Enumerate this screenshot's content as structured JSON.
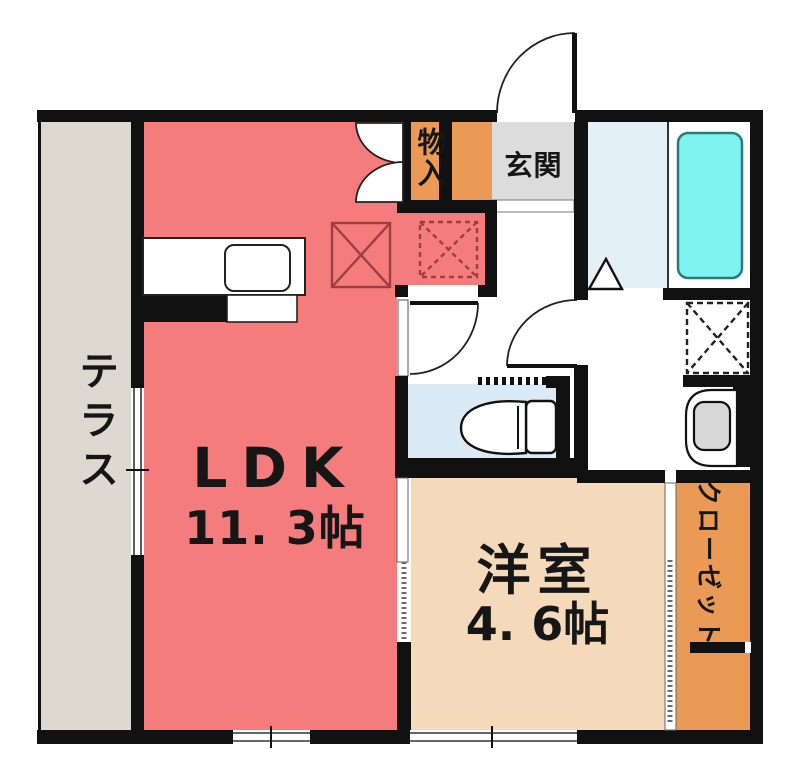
{
  "floorplan": {
    "rooms": {
      "terrace": {
        "label": "テラス"
      },
      "ldk": {
        "label": "LDK",
        "size": "11. 3帖"
      },
      "storage": {
        "label": "物入"
      },
      "entrance": {
        "label": "玄関"
      },
      "western_room": {
        "label": "洋室",
        "size": "4. 6帖"
      },
      "closet": {
        "label": "クローゼット"
      }
    },
    "colors": {
      "ldk": "#F57C7C",
      "terrace": "#DDD8D0",
      "entrance_floor": "#DCDCDC",
      "storage_orange": "#EB9A55",
      "western_room": "#F4D9BA",
      "closet": "#EB9A55",
      "bathroom_floor": "#E4F0F8",
      "toilet_floor": "#DCEAF6",
      "bathtub": "#7FF3EF",
      "bathtub_border": "#2A7B79",
      "wall": "#111111",
      "fixture_gray": "#D8D8D8",
      "marker_red": "#9B3F3F"
    }
  }
}
